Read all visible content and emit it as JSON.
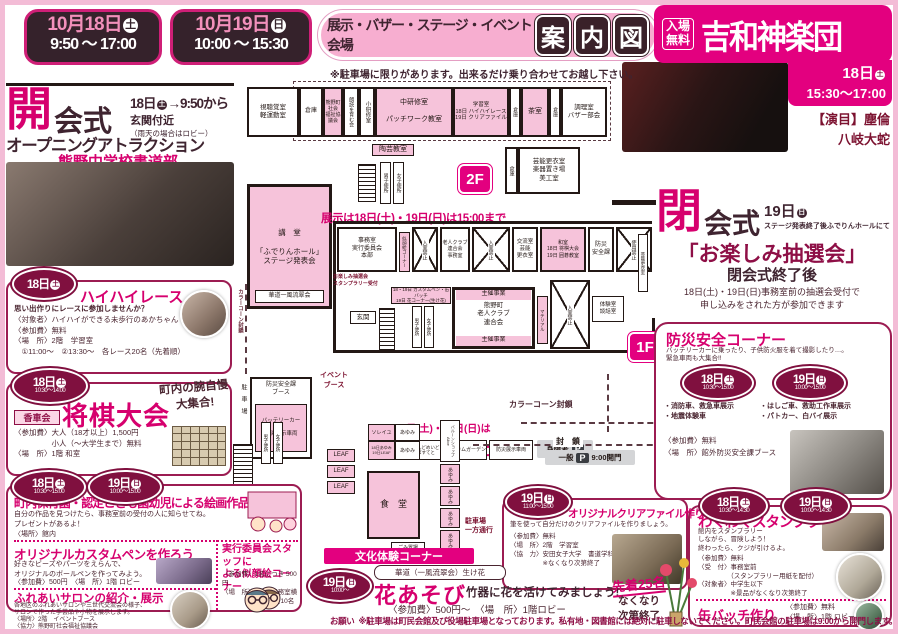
{
  "header": {
    "dates": [
      {
        "date": "10月18日",
        "dow": "土",
        "time": "9:50 ～ 17:00"
      },
      {
        "date": "10月19日",
        "dow": "日",
        "time": "10:00 ～ 15:30"
      }
    ],
    "venue_label": "展示・バザー・ステージ・イベント会場",
    "title_chars": [
      "案",
      "内",
      "図"
    ],
    "parking_note": "※駐車場に限りがあります。出来るだけ乗り合わせてお越し下さい。",
    "kagura": {
      "free": "入場\n無料",
      "name": "吉和神楽団",
      "day": "18日",
      "dow": "土",
      "time": "15:30～17:00",
      "program_label": "【演目】",
      "program1": "塵倫",
      "program2": "八岐大蛇"
    }
  },
  "opening": {
    "big": "開",
    "rest": "会式",
    "when": "18日",
    "dow": "土",
    "when2": "→9:50から",
    "place": "玄関付近",
    "place_note": "（雨天の場合はロビー）",
    "attraction": "オープニングアトラクション",
    "performer": "熊野中学校書道部"
  },
  "haihai": {
    "day": "18日",
    "dow": "土",
    "title": "ハイハイレース",
    "lead": "思い出作りにレースに参加しませんか？",
    "lines": "〈対象者〉ハイハイができる未歩行のあかちゃん\n〈参加費〉無料\n〈場　所〉2階　学習室\n　①11:00～　②13:30～　各レース20名（先着順）"
  },
  "shogi": {
    "day": "18日",
    "dow": "土",
    "time": "10:30～14:00",
    "club": "香車会",
    "title": "将棋大会",
    "catch": "町内の腕自慢\n大集合!",
    "lines": "〈参加費〉大人（18才以上）1,500円\n　　　　　小人（～大学生まで）無料\n〈場　所〉1階 和室"
  },
  "kaiga": {
    "b1": {
      "day": "18日",
      "dow": "土",
      "time": "10:30～15:00"
    },
    "b2": {
      "day": "19日",
      "dow": "日",
      "time": "10:00～15:00"
    },
    "title": "町内保育園・認定こども園幼児による絵画作品展示",
    "desc": "自分の作品を見つけたら、事務室前の受付の人に知らせてね。\nプレゼントがあるよ！",
    "place": "〈場所〉館内"
  },
  "custompen": {
    "title": "オリジナルカスタムペンを作ろう",
    "desc": "好きなビーズやパーツをえらんで、\nオリジナルのボールペンを作ってみよう。",
    "fee": "〈参加費〉500円　〈場　所〉1階 ロビー"
  },
  "nigaoe": {
    "title": "実行委員会スタッフに\nよる似顔絵コーナー",
    "lines": "〈参加費〉1名につき 500円\n〈場　所〉1階　事務室横\n　　　　　各日先着10名"
  },
  "salon": {
    "title": "ふれあいサロンの紹介・展示",
    "desc": "各地区のふれあいサロンや三世代交流会の様子、\nサロンで作った手芸品や小物を展示します。",
    "lines": "〈場所〉2階　イベントブース\n〈協力〉熊野町社会福祉協議会"
  },
  "closing": {
    "big": "閉",
    "rest": "会式",
    "when": "19日",
    "dow": "日",
    "sub": "ステージ発表終了後ふでりんホールにて",
    "title": "「お楽しみ抽選会」",
    "after": "閉会式終了後",
    "desc": "18日(土)・19日(日)事務室前の抽選会受付で\n申し込みをされた方が参加できます"
  },
  "bousai": {
    "title": "防災安全コーナー",
    "desc": "バッテリーカーに乗ったり、子供防火服を着て撮影したり…。\n緊急車両も大集合!!",
    "b1": {
      "day": "18日",
      "dow": "土",
      "time": "10:30～15:00",
      "items": "・消防車、救急車展示\n・地震体験車"
    },
    "b2": {
      "day": "19日",
      "dow": "日",
      "time": "10:00～15:00",
      "items": "・はしご車、救助工作車展示\n・パトカー、白バイ展示"
    },
    "fee": "〈参加費〉無料",
    "place": "〈場　所〉館外防災安全課ブース"
  },
  "stamp": {
    "b1": {
      "day": "18日",
      "dow": "土",
      "time": "10:30～14:30"
    },
    "b2": {
      "day": "19日",
      "dow": "日",
      "time": "10:00～14:30"
    },
    "title": "わくわくスタンプラリー",
    "desc": "館内をスタンプラリー\nしながら、冒険しよう！\n終わったら、クジが引けるよ。",
    "lines": "〈参加費〉無料\n〈受　付〉事務室前\n　　　　　（スタンプラリー用紙を配付）\n〈対象者〉中学生以下\n　　　　　※景品がなくなり次第終了"
  },
  "kanbatch": {
    "title": "缶バッチ作り",
    "lines": "〈参加費〉無料\n〈場　所〉1階 ロビー"
  },
  "clearfile": {
    "day": "19日",
    "dow": "日",
    "time": "11:00～15:00",
    "title": "オリジナルクリアファイル作り!",
    "desc": "筆を使って自分だけのクリアファイルを作りましょう。",
    "lines": "〈参加費〉無料\n〈場　所〉2階　学習室\n〈協　力〉安田女子大学　書道学科\n　　　　　※なくなり次第終了"
  },
  "bunka": {
    "header": "文化体験コーナー",
    "day": "19日",
    "dow": "日",
    "time": "10:00～",
    "school": "華道（一風流翠会）生け花",
    "title": "花あそび",
    "sub": "竹器に花を活けてみましょう!",
    "fee": "〈参加費〉500円～　〈場　所〉1階ロビー",
    "limit": "先着25名",
    "limit2": "なくなり\n次第終了"
  },
  "map": {
    "exhibit_note": "展示は18日(土)・19日(日)は15:00まで",
    "f2_badge": "2F",
    "f1_badge": "1F",
    "f2_rooms": [
      "視聴覚室\n軽運動室",
      "倉庫",
      "熊野町社会\n福祉協議会",
      "朗読を育む会",
      "小研修室",
      "中研修室\n\nパッチワーク教室",
      "学習室\n18日 ハイハイレース\n19日 クリアファイル",
      "倉庫",
      "茶室",
      "倉庫",
      "調理室\nバザー部会"
    ],
    "tougei": "陶芸教室",
    "hall": "講　堂\n\n「ふでりんホール」\nステージ発表会",
    "hall_chip": "華道一風流翠会",
    "f2_right": "芸能更衣室\n楽器置き場\n美工室",
    "f2_storage": "倉庫",
    "toilet_m": "男子便所",
    "toilet_f": "女子便所",
    "f1_rooms": [
      "事務室\n実行委員会\n本部",
      "似顔絵コーナー",
      "入室禁止",
      "老人クラブ\n連合会\n事務室",
      "入室禁止",
      "交流室\n芸能\n更衣室",
      "和室\n18日 将棋大会\n19日 囲碁教室",
      "防災\n安全課",
      "使用禁止"
    ],
    "uketsuke1": "お楽しみ抽選会\nスタンプラリー受付",
    "uketsuke2": "18・19日 カスタムペン・缶バッチ\n19日 花コーナー(生け花)",
    "genkan": "玄関",
    "shusai": "主催事業",
    "rouin": "熊野町\n老人クラブ\n連合会",
    "material": "マテリアル",
    "nyushitsu": "入室禁止",
    "taiken": "体験室\n談話室",
    "dayroom": "デイルーム",
    "geino2": "芸能更衣室",
    "event_booth": "イベント\nブース",
    "bousai_booth": "防災安全課\nブース",
    "battery": "バッテリーカー\n＆\n防災展示車両",
    "parking_v": "駐　車　場",
    "cone": "カラーコーン封鎖",
    "no_through1": "※18日(土)・19日(日)は",
    "no_through2": "通り抜け禁止",
    "booths": [
      "ともある",
      "はんどめいど\nばすてと",
      "カムカムガーデン",
      "防災展示車両"
    ],
    "shintai": "身障者",
    "p": "P",
    "fusa": "封　鎖",
    "ippan": "一般",
    "ippan2": "9:00開門",
    "soleil": "ソレイユ",
    "ayumi": "あゆみ",
    "leaf18": "18日あゆみ\n19日LEAF",
    "leaf": "LEAF",
    "shokudo": "食　堂",
    "alice": "バルーンショップAlice",
    "oneway": "駐車場\n一方通行",
    "gomi": "ごみ置場"
  },
  "footer": {
    "label": "お願い",
    "text": "※駐車場は町民会館及び役場駐車場となっております。私有地・図書館には絶対に駐車しないでください。町民会館の駐車場は9:00から開門します。"
  }
}
